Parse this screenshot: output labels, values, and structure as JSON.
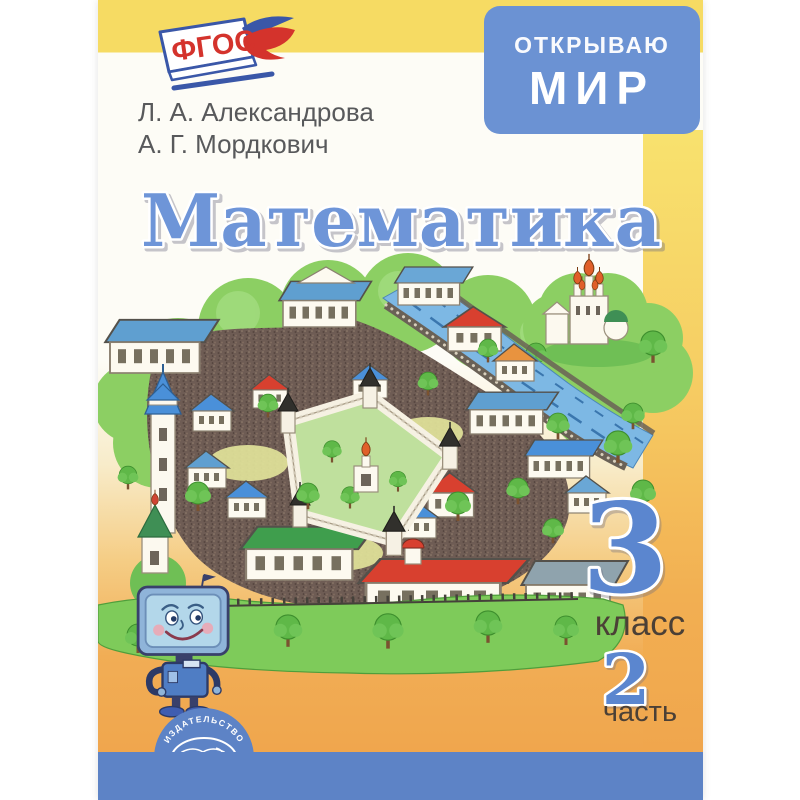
{
  "cover": {
    "fgos_label": "ФГОС",
    "series": {
      "line1": "ОТКРЫВАЮ",
      "line2": "МИР"
    },
    "authors": [
      "Л. А. Александрова",
      "А. Г. Мордкович"
    ],
    "title": "Математика",
    "grade_number": "3",
    "grade_label": "класс",
    "part_number": "2",
    "part_label": "часть",
    "publisher": {
      "arc_top": "ИЗДАТЕЛЬСТВО",
      "arc_bottom": "МНЕМОЗИНА"
    },
    "colors": {
      "top_band": "#F6DB63",
      "series_badge_blue": "#6B92D3",
      "title_blue": "#6E95D8",
      "orange": "#F0A64D",
      "bottom_band_blue": "#5D83C6",
      "fgos_red": "#D4332C"
    },
    "icons": {
      "fgos_logo": "open-book-with-dove",
      "publisher_logo": "mnemozina-open-book-and-muse-profile",
      "mascot": "tv-headed-robot",
      "illustration": "aerial-cartoon-town-with-river-and-kremlin"
    }
  }
}
